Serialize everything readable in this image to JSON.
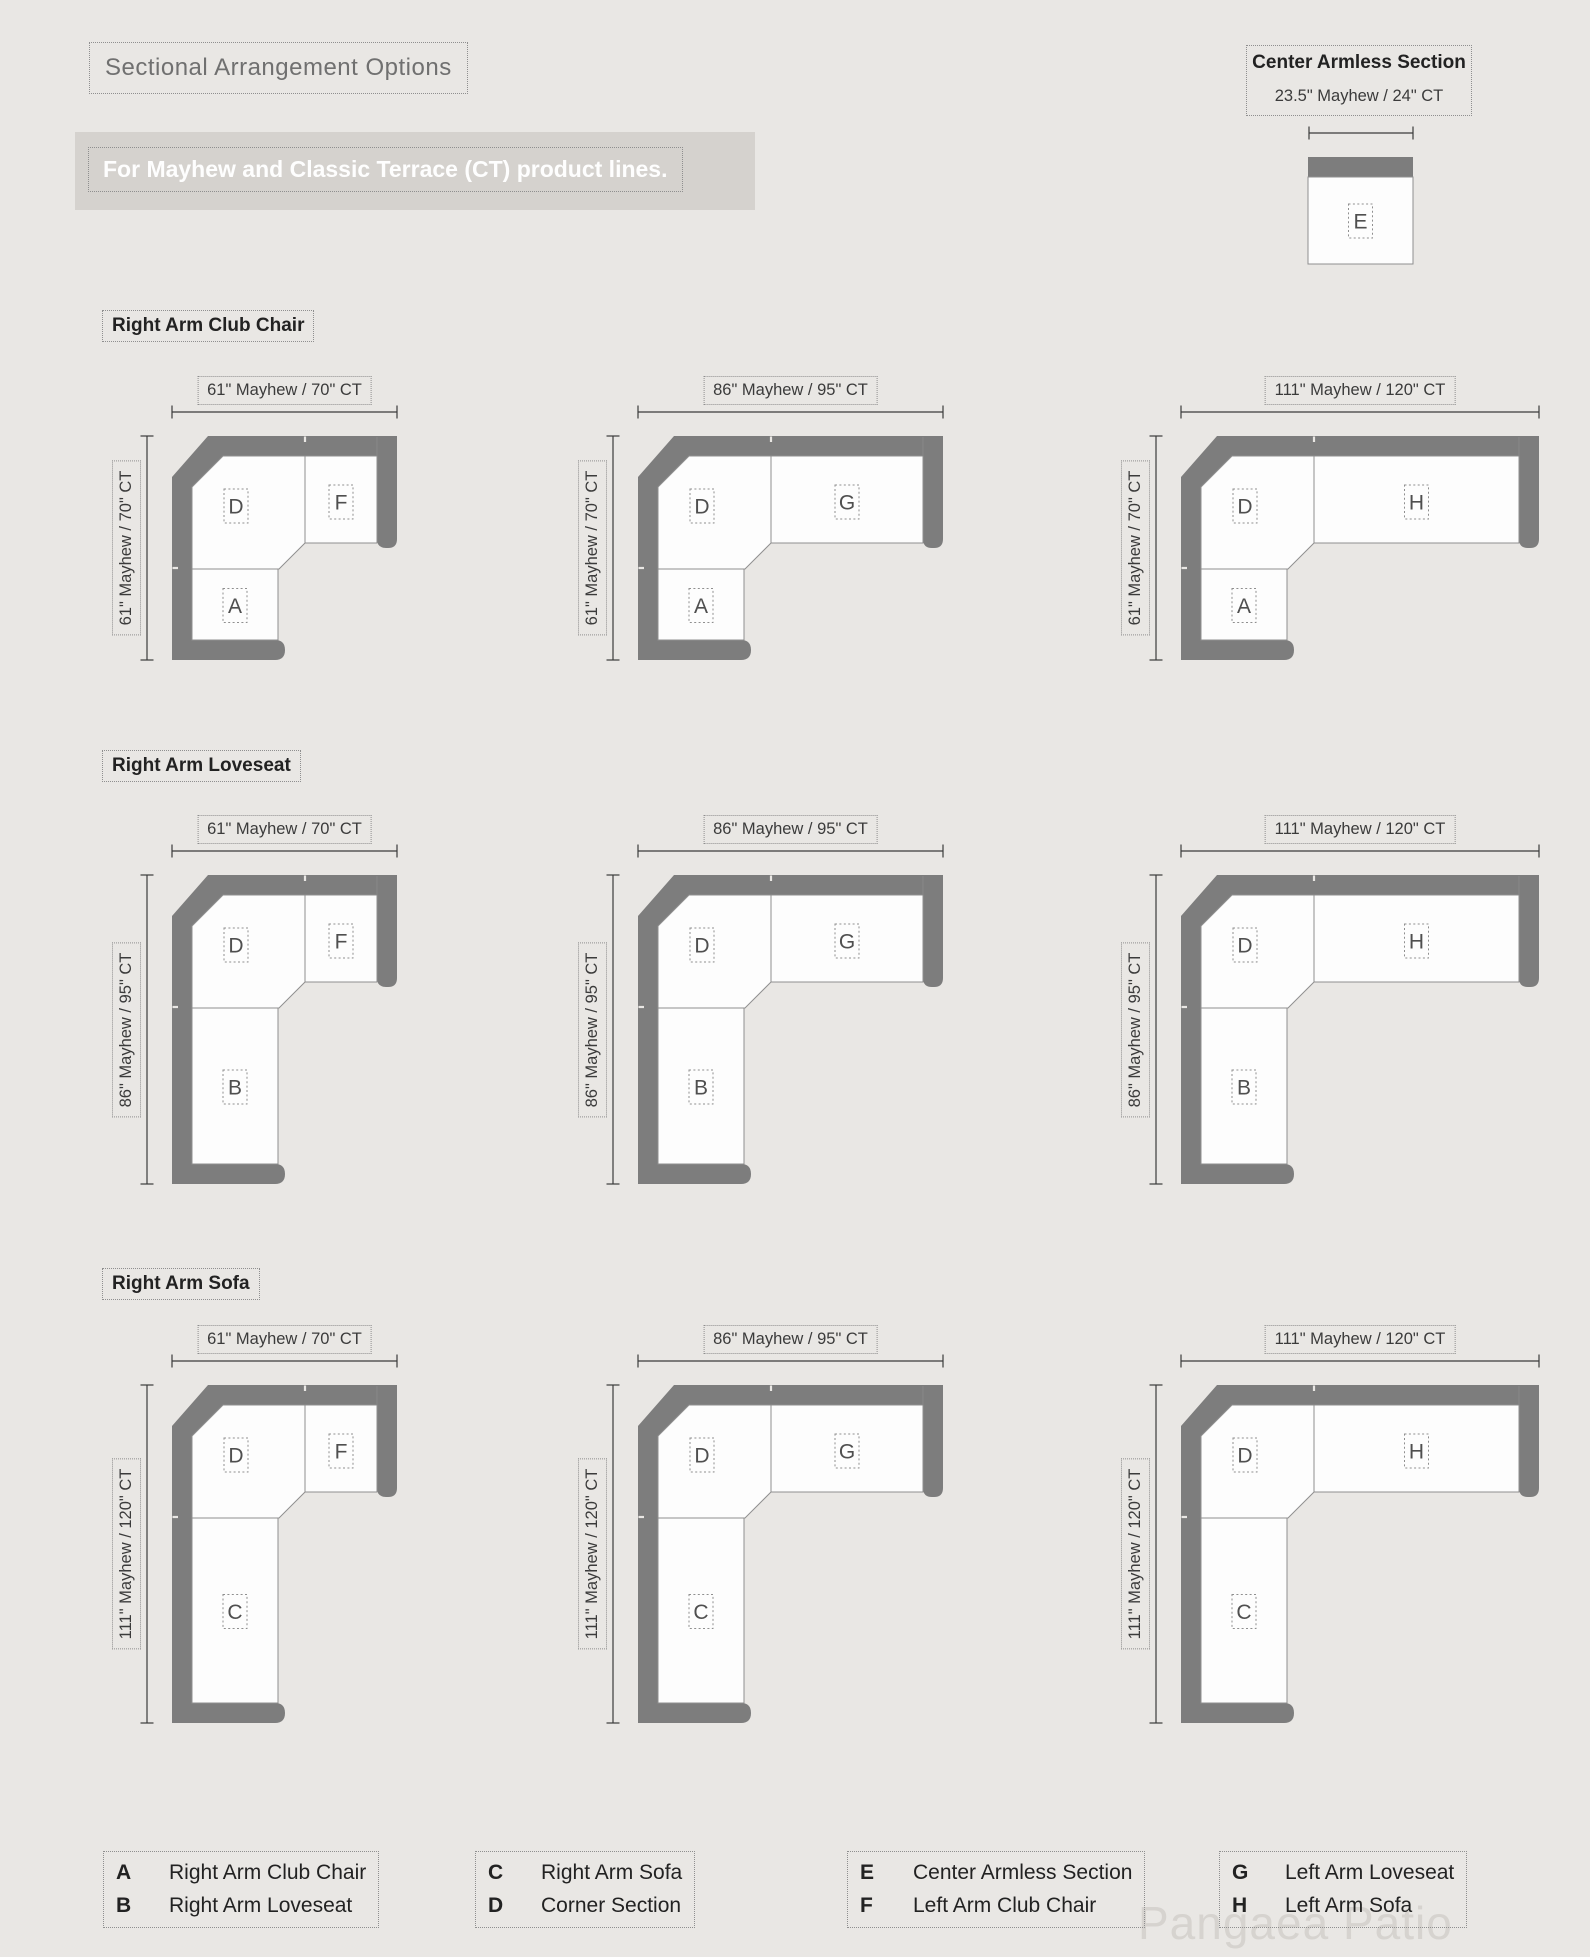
{
  "page": {
    "title": "Sectional Arrangement Options",
    "subtitle": "For Mayhew and Classic Terrace (CT) product lines.",
    "watermark": "Pangaea Patio"
  },
  "colors": {
    "background": "#e9e7e4",
    "banner_background": "#d5d2ce",
    "banner_text": "#fefefe",
    "sofa_back_gray": "#7d7d7d",
    "seat_fill": "#fdfdfd",
    "seat_outline": "#8f8f8f",
    "dimension_line": "#3b3b3b",
    "section_letter": "#4f4f4f",
    "heading_text": "#222222",
    "title_text": "#707070",
    "dotted_border": "#8f8f8f",
    "watermark_text": "#d6d3cf"
  },
  "center_armless": {
    "title": "Center Armless Section",
    "dimension": "23.5\" Mayhew  /  24\" CT",
    "letter": "E"
  },
  "corner_letter": "D",
  "rows": [
    {
      "heading": "Right Arm Club Chair",
      "vertical_dimension": "61\" Mayhew  /  70\" CT",
      "bottom_letter": "A"
    },
    {
      "heading": "Right Arm Loveseat",
      "vertical_dimension": "86\" Mayhew  /  95\" CT",
      "bottom_letter": "B"
    },
    {
      "heading": "Right Arm Sofa",
      "vertical_dimension": "111\" Mayhew  /  120\" CT",
      "bottom_letter": "C"
    }
  ],
  "columns": [
    {
      "horizontal_dimension": "61\" Mayhew  /  70\" CT",
      "right_letter": "F"
    },
    {
      "horizontal_dimension": "86\" Mayhew  /  95\" CT",
      "right_letter": "G"
    },
    {
      "horizontal_dimension": "111\" Mayhew  /  120\" CT",
      "right_letter": "H"
    }
  ],
  "legend": [
    {
      "key": "A",
      "label": "Right Arm Club Chair"
    },
    {
      "key": "B",
      "label": "Right Arm Loveseat"
    },
    {
      "key": "C",
      "label": "Right Arm Sofa"
    },
    {
      "key": "D",
      "label": "Corner Section"
    },
    {
      "key": "E",
      "label": "Center Armless Section"
    },
    {
      "key": "F",
      "label": "Left Arm Club Chair"
    },
    {
      "key": "G",
      "label": "Left Arm Loveseat"
    },
    {
      "key": "H",
      "label": "Left Arm Sofa"
    }
  ]
}
